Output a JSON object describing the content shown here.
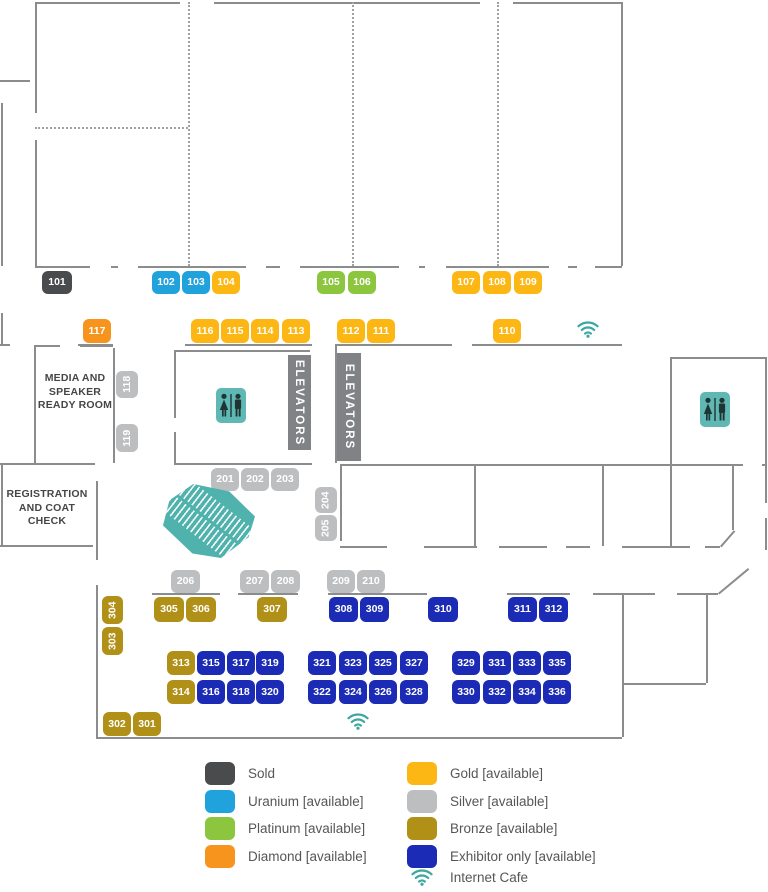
{
  "rooms": {
    "media": "MEDIA AND\nSPEAKER\nREADY ROOM",
    "registration": "REGISTRATION\nAND COAT CHECK",
    "elevator_label": "ELEVATORS"
  },
  "tiers": {
    "sold": {
      "label": "Sold",
      "color": "#4a4b4d"
    },
    "uranium": {
      "label": "Uranium [available]",
      "color": "#20a3dc"
    },
    "platinum": {
      "label": "Platinum [available]",
      "color": "#8cc63f"
    },
    "diamond": {
      "label": "Diamond [available]",
      "color": "#f7941e"
    },
    "gold": {
      "label": "Gold [available]",
      "color": "#fdb714"
    },
    "silver": {
      "label": "Silver [available]",
      "color": "#bcbec0"
    },
    "bronze": {
      "label": "Bronze [available]",
      "color": "#b19017"
    },
    "exhibitor": {
      "label": "Exhibitor only [available]",
      "color": "#1b2bb5"
    }
  },
  "legend": {
    "internet_cafe_label": "Internet Cafe",
    "columns": [
      {
        "x": 205,
        "tiers": [
          "sold",
          "uranium",
          "platinum",
          "diamond"
        ]
      },
      {
        "x": 407,
        "tiers": [
          "gold",
          "silver",
          "bronze",
          "exhibitor"
        ]
      }
    ],
    "first_row_y": 762,
    "row_step": 27.5,
    "cafe_row_y": 868
  },
  "accent": {
    "teal": "#3bA79f",
    "restroom_bg": "#5fb8b3",
    "figure": "#1e3533"
  },
  "booths": [
    {
      "n": "101",
      "t": "sold",
      "x": 42,
      "y": 271,
      "w": 30,
      "h": 23
    },
    {
      "n": "102",
      "t": "uranium",
      "x": 152,
      "y": 271,
      "w": 28,
      "h": 23
    },
    {
      "n": "103",
      "t": "uranium",
      "x": 182,
      "y": 271,
      "w": 28,
      "h": 23
    },
    {
      "n": "104",
      "t": "gold",
      "x": 212,
      "y": 271,
      "w": 28,
      "h": 23
    },
    {
      "n": "105",
      "t": "platinum",
      "x": 317,
      "y": 271,
      "w": 28,
      "h": 23
    },
    {
      "n": "106",
      "t": "platinum",
      "x": 348,
      "y": 271,
      "w": 28,
      "h": 23
    },
    {
      "n": "107",
      "t": "gold",
      "x": 452,
      "y": 271,
      "w": 28,
      "h": 23
    },
    {
      "n": "108",
      "t": "gold",
      "x": 483,
      "y": 271,
      "w": 28,
      "h": 23
    },
    {
      "n": "109",
      "t": "gold",
      "x": 514,
      "y": 271,
      "w": 28,
      "h": 23
    },
    {
      "n": "117",
      "t": "diamond",
      "x": 83,
      "y": 319,
      "w": 28,
      "h": 24
    },
    {
      "n": "116",
      "t": "gold",
      "x": 191,
      "y": 319,
      "w": 28,
      "h": 24
    },
    {
      "n": "115",
      "t": "gold",
      "x": 221,
      "y": 319,
      "w": 28,
      "h": 24
    },
    {
      "n": "114",
      "t": "gold",
      "x": 251,
      "y": 319,
      "w": 28,
      "h": 24
    },
    {
      "n": "113",
      "t": "gold",
      "x": 282,
      "y": 319,
      "w": 28,
      "h": 24
    },
    {
      "n": "112",
      "t": "gold",
      "x": 337,
      "y": 319,
      "w": 28,
      "h": 24
    },
    {
      "n": "111",
      "t": "gold",
      "x": 367,
      "y": 319,
      "w": 28,
      "h": 24
    },
    {
      "n": "110",
      "t": "gold",
      "x": 493,
      "y": 319,
      "w": 28,
      "h": 24
    },
    {
      "n": "118",
      "t": "silver",
      "x": 116,
      "y": 371,
      "w": 22,
      "h": 27,
      "v": true
    },
    {
      "n": "119",
      "t": "silver",
      "x": 116,
      "y": 424,
      "w": 22,
      "h": 28,
      "v": true
    },
    {
      "n": "201",
      "t": "silver",
      "x": 211,
      "y": 468,
      "w": 28,
      "h": 23
    },
    {
      "n": "202",
      "t": "silver",
      "x": 241,
      "y": 468,
      "w": 28,
      "h": 23
    },
    {
      "n": "203",
      "t": "silver",
      "x": 271,
      "y": 468,
      "w": 28,
      "h": 23
    },
    {
      "n": "204",
      "t": "silver",
      "x": 315,
      "y": 487,
      "w": 22,
      "h": 26,
      "v": true
    },
    {
      "n": "205",
      "t": "silver",
      "x": 315,
      "y": 515,
      "w": 22,
      "h": 26,
      "v": true
    },
    {
      "n": "206",
      "t": "silver",
      "x": 171,
      "y": 570,
      "w": 29,
      "h": 23
    },
    {
      "n": "207",
      "t": "silver",
      "x": 240,
      "y": 570,
      "w": 29,
      "h": 23
    },
    {
      "n": "208",
      "t": "silver",
      "x": 271,
      "y": 570,
      "w": 29,
      "h": 23
    },
    {
      "n": "209",
      "t": "silver",
      "x": 327,
      "y": 570,
      "w": 28,
      "h": 23
    },
    {
      "n": "210",
      "t": "silver",
      "x": 357,
      "y": 570,
      "w": 28,
      "h": 23
    },
    {
      "n": "305",
      "t": "bronze",
      "x": 154,
      "y": 597,
      "w": 30,
      "h": 25
    },
    {
      "n": "306",
      "t": "bronze",
      "x": 186,
      "y": 597,
      "w": 30,
      "h": 25
    },
    {
      "n": "307",
      "t": "bronze",
      "x": 257,
      "y": 597,
      "w": 30,
      "h": 25
    },
    {
      "n": "308",
      "t": "exhibitor",
      "x": 329,
      "y": 597,
      "w": 29,
      "h": 25
    },
    {
      "n": "309",
      "t": "exhibitor",
      "x": 360,
      "y": 597,
      "w": 29,
      "h": 25
    },
    {
      "n": "310",
      "t": "exhibitor",
      "x": 428,
      "y": 597,
      "w": 30,
      "h": 25
    },
    {
      "n": "311",
      "t": "exhibitor",
      "x": 508,
      "y": 597,
      "w": 29,
      "h": 25
    },
    {
      "n": "312",
      "t": "exhibitor",
      "x": 539,
      "y": 597,
      "w": 29,
      "h": 25
    },
    {
      "n": "304",
      "t": "bronze",
      "x": 102,
      "y": 596,
      "w": 21,
      "h": 28,
      "v": true
    },
    {
      "n": "303",
      "t": "bronze",
      "x": 102,
      "y": 627,
      "w": 21,
      "h": 28,
      "v": true
    },
    {
      "n": "313",
      "t": "bronze",
      "x": 167,
      "y": 651,
      "w": 28,
      "h": 24
    },
    {
      "n": "315",
      "t": "exhibitor",
      "x": 197,
      "y": 651,
      "w": 28,
      "h": 24
    },
    {
      "n": "317",
      "t": "exhibitor",
      "x": 227,
      "y": 651,
      "w": 28,
      "h": 24
    },
    {
      "n": "319",
      "t": "exhibitor",
      "x": 256,
      "y": 651,
      "w": 28,
      "h": 24
    },
    {
      "n": "321",
      "t": "exhibitor",
      "x": 308,
      "y": 651,
      "w": 28,
      "h": 24
    },
    {
      "n": "323",
      "t": "exhibitor",
      "x": 339,
      "y": 651,
      "w": 28,
      "h": 24
    },
    {
      "n": "325",
      "t": "exhibitor",
      "x": 369,
      "y": 651,
      "w": 28,
      "h": 24
    },
    {
      "n": "327",
      "t": "exhibitor",
      "x": 400,
      "y": 651,
      "w": 28,
      "h": 24
    },
    {
      "n": "329",
      "t": "exhibitor",
      "x": 452,
      "y": 651,
      "w": 28,
      "h": 24
    },
    {
      "n": "331",
      "t": "exhibitor",
      "x": 483,
      "y": 651,
      "w": 28,
      "h": 24
    },
    {
      "n": "333",
      "t": "exhibitor",
      "x": 513,
      "y": 651,
      "w": 28,
      "h": 24
    },
    {
      "n": "335",
      "t": "exhibitor",
      "x": 543,
      "y": 651,
      "w": 28,
      "h": 24
    },
    {
      "n": "314",
      "t": "bronze",
      "x": 167,
      "y": 680,
      "w": 28,
      "h": 24
    },
    {
      "n": "316",
      "t": "exhibitor",
      "x": 197,
      "y": 680,
      "w": 28,
      "h": 24
    },
    {
      "n": "318",
      "t": "exhibitor",
      "x": 227,
      "y": 680,
      "w": 28,
      "h": 24
    },
    {
      "n": "320",
      "t": "exhibitor",
      "x": 256,
      "y": 680,
      "w": 28,
      "h": 24
    },
    {
      "n": "322",
      "t": "exhibitor",
      "x": 308,
      "y": 680,
      "w": 28,
      "h": 24
    },
    {
      "n": "324",
      "t": "exhibitor",
      "x": 339,
      "y": 680,
      "w": 28,
      "h": 24
    },
    {
      "n": "326",
      "t": "exhibitor",
      "x": 369,
      "y": 680,
      "w": 28,
      "h": 24
    },
    {
      "n": "328",
      "t": "exhibitor",
      "x": 400,
      "y": 680,
      "w": 28,
      "h": 24
    },
    {
      "n": "330",
      "t": "exhibitor",
      "x": 452,
      "y": 680,
      "w": 28,
      "h": 24
    },
    {
      "n": "332",
      "t": "exhibitor",
      "x": 483,
      "y": 680,
      "w": 28,
      "h": 24
    },
    {
      "n": "334",
      "t": "exhibitor",
      "x": 513,
      "y": 680,
      "w": 28,
      "h": 24
    },
    {
      "n": "336",
      "t": "exhibitor",
      "x": 543,
      "y": 680,
      "w": 28,
      "h": 24
    },
    {
      "n": "302",
      "t": "bronze",
      "x": 103,
      "y": 712,
      "w": 28,
      "h": 24
    },
    {
      "n": "301",
      "t": "bronze",
      "x": 133,
      "y": 712,
      "w": 28,
      "h": 24
    }
  ],
  "elevators": [
    {
      "x": 288,
      "y": 355,
      "w": 23,
      "h": 95
    },
    {
      "x": 337,
      "y": 353,
      "w": 24,
      "h": 108
    }
  ],
  "restrooms": [
    {
      "x": 216,
      "y": 388
    },
    {
      "x": 700,
      "y": 392
    }
  ],
  "wifi_icons": [
    {
      "x": 577,
      "y": 320
    },
    {
      "x": 347,
      "y": 712
    }
  ],
  "escalator": {
    "x": 163,
    "y": 484,
    "w": 92,
    "h": 74
  },
  "geometry": {
    "walls_h": [
      [
        2,
        35,
        180
      ],
      [
        2,
        214,
        480
      ],
      [
        2,
        513,
        621
      ],
      [
        80,
        0,
        30
      ],
      [
        266,
        35,
        90
      ],
      [
        266,
        111,
        118
      ],
      [
        266,
        138,
        246
      ],
      [
        266,
        266,
        280
      ],
      [
        266,
        300,
        399
      ],
      [
        266,
        419,
        425
      ],
      [
        266,
        446,
        549
      ],
      [
        266,
        568,
        577
      ],
      [
        266,
        595,
        622
      ],
      [
        344,
        0,
        10
      ],
      [
        344,
        78,
        113
      ],
      [
        344,
        185,
        312
      ],
      [
        344,
        335,
        452
      ],
      [
        344,
        472,
        622
      ],
      [
        345,
        34,
        60
      ],
      [
        345,
        80,
        113
      ],
      [
        350,
        174,
        310
      ],
      [
        357,
        670,
        765
      ],
      [
        463,
        0,
        95
      ],
      [
        463,
        174,
        312
      ],
      [
        464,
        340,
        743
      ],
      [
        464,
        762,
        765
      ],
      [
        545,
        0,
        93
      ],
      [
        546,
        340,
        387
      ],
      [
        546,
        424,
        477
      ],
      [
        546,
        499,
        547
      ],
      [
        546,
        566,
        590
      ],
      [
        546,
        622,
        690
      ],
      [
        546,
        705,
        720
      ],
      [
        593,
        152,
        220
      ],
      [
        593,
        238,
        298
      ],
      [
        593,
        328,
        427
      ],
      [
        593,
        507,
        570
      ],
      [
        593,
        593,
        655
      ],
      [
        593,
        677,
        718
      ],
      [
        683,
        622,
        706
      ],
      [
        737,
        96,
        622
      ]
    ],
    "walls_v": [
      [
        35,
        2,
        113
      ],
      [
        35,
        140,
        266
      ],
      [
        1,
        103,
        266
      ],
      [
        1,
        313,
        344
      ],
      [
        1,
        463,
        545
      ],
      [
        621,
        2,
        266
      ],
      [
        34,
        345,
        463
      ],
      [
        113,
        348,
        463
      ],
      [
        174,
        351,
        418
      ],
      [
        174,
        432,
        463
      ],
      [
        335,
        344,
        463
      ],
      [
        96,
        481,
        560
      ],
      [
        96,
        585,
        737
      ],
      [
        340,
        464,
        541
      ],
      [
        474,
        464,
        546
      ],
      [
        602,
        464,
        546
      ],
      [
        670,
        357,
        546
      ],
      [
        732,
        464,
        530
      ],
      [
        765,
        357,
        503
      ],
      [
        765,
        518,
        550
      ],
      [
        622,
        593,
        737
      ],
      [
        706,
        593,
        683
      ]
    ],
    "dash_v": [
      [
        188,
        2,
        266
      ],
      [
        352,
        2,
        266
      ],
      [
        497,
        2,
        266
      ]
    ],
    "dash_h": [
      [
        127,
        35,
        188
      ]
    ],
    "diagonals": [
      [
        720,
        546,
        734,
        530
      ],
      [
        718,
        593,
        748,
        568
      ]
    ]
  }
}
